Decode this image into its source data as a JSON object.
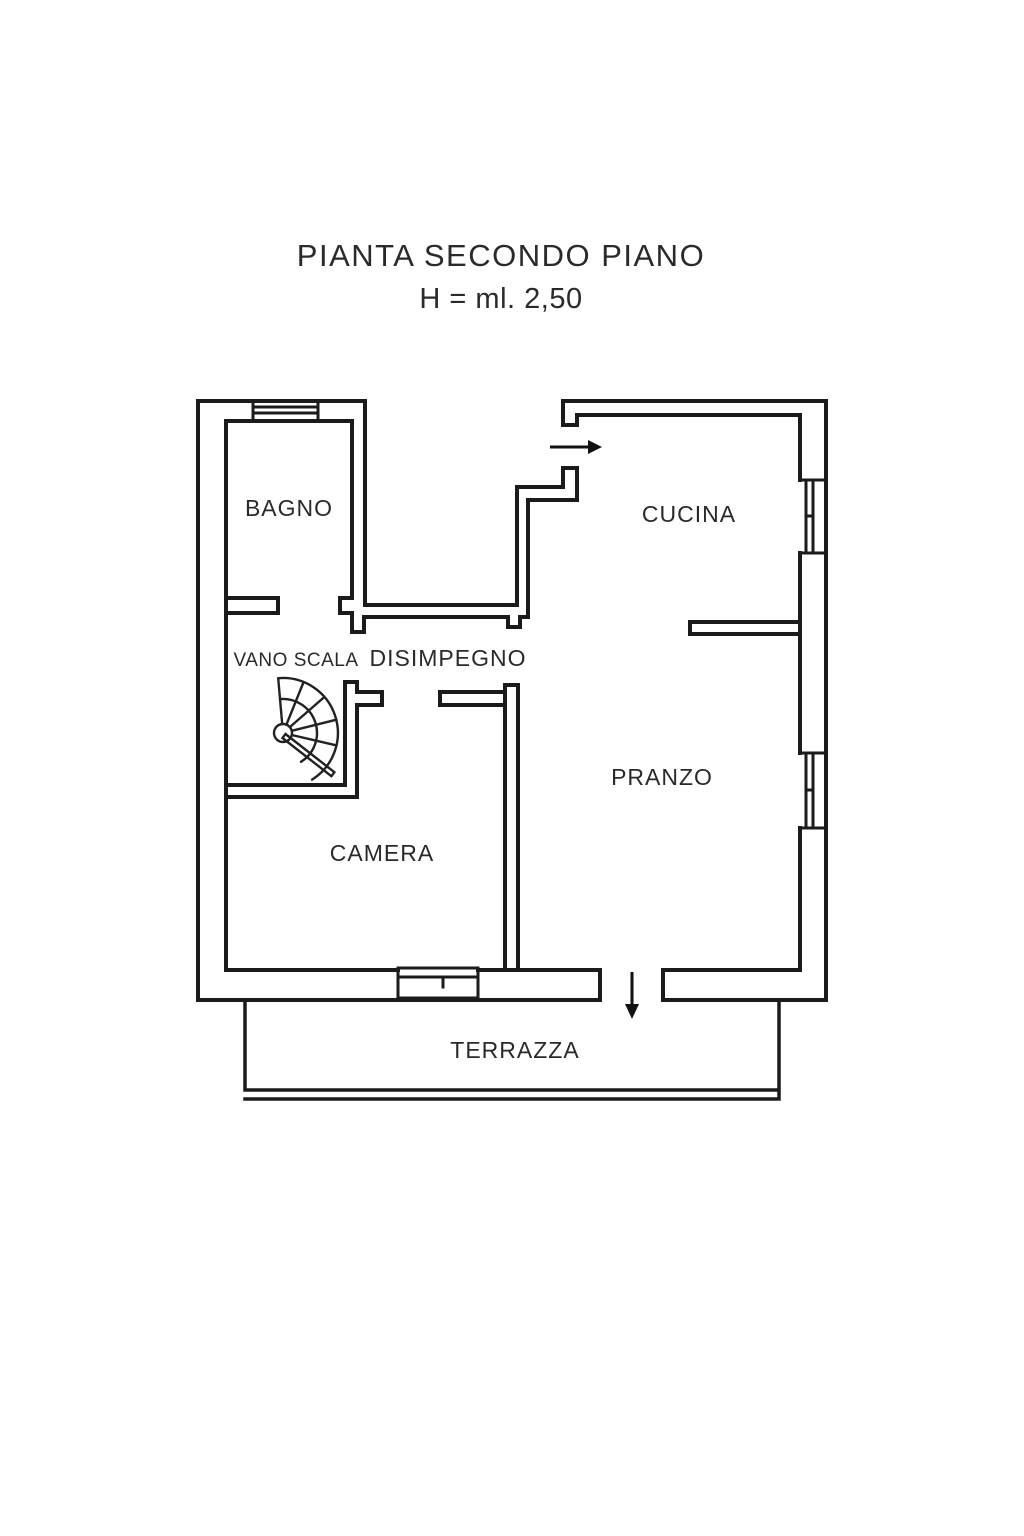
{
  "header": {
    "title": "PIANTA SECONDO PIANO",
    "height_label": "H = ml. 2,50"
  },
  "rooms": {
    "bagno": {
      "label": "BAGNO"
    },
    "cucina": {
      "label": "CUCINA"
    },
    "vano_scala": {
      "label": "VANO SCALA"
    },
    "disimpegno": {
      "label": "DISIMPEGNO"
    },
    "pranzo": {
      "label": "PRANZO"
    },
    "camera": {
      "label": "CAMERA"
    },
    "terrazza": {
      "label": "TERRAZZA"
    }
  },
  "symbols": {
    "staircase": "spiral-staircase",
    "entry_arrow": "entry-arrow-into-cucina",
    "terrace_arrow": "door-arrow-to-terrazza",
    "windows": [
      "bagno-top-window",
      "cucina-right-window",
      "pranzo-right-window",
      "camera-bottom-window"
    ]
  },
  "colors": {
    "background": "#ffffff",
    "line": "#1b1b1b",
    "text": "#2a2a2a"
  }
}
